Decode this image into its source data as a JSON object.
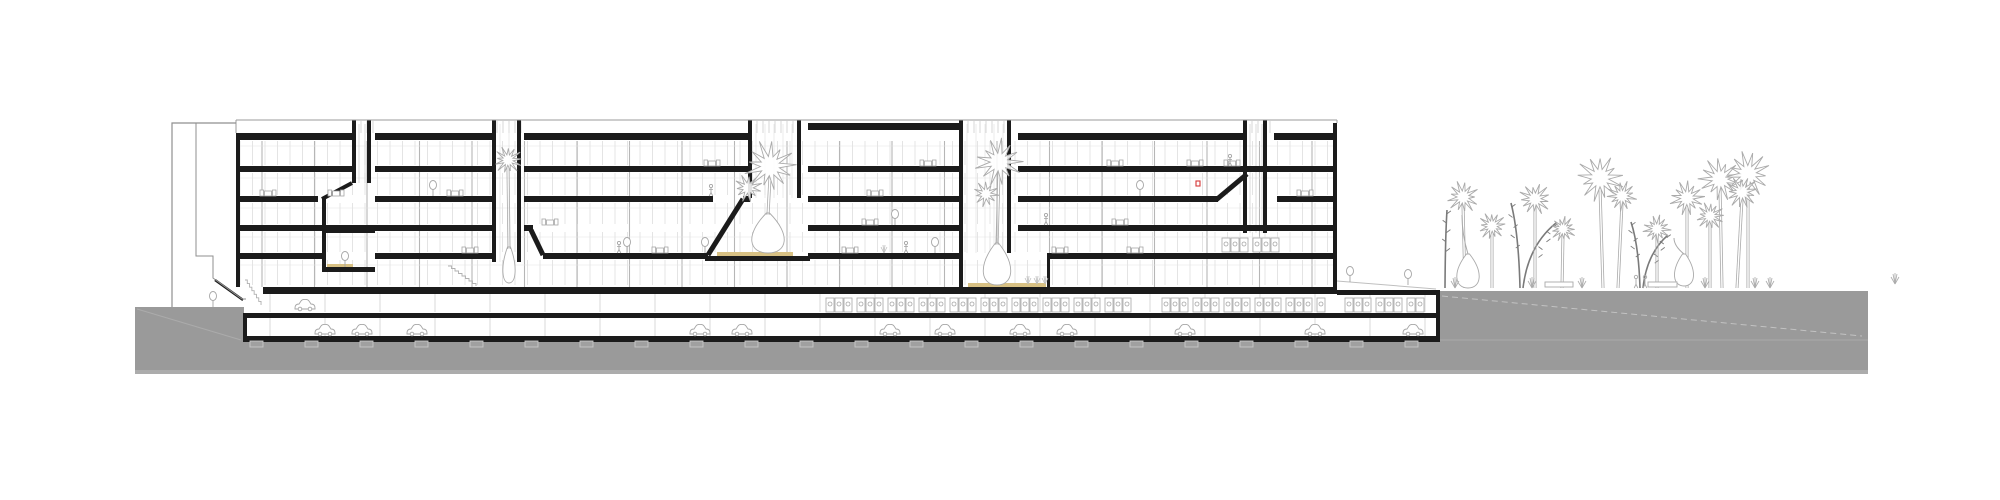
{
  "drawing": {
    "kind": "architectural-building-section",
    "canvas": {
      "w": 2000,
      "h": 500
    }
  },
  "colors": {
    "ink": "#1b1b1b",
    "ground": "#9a9a9a",
    "groundEdge": "#b3b3b3",
    "mullion": "#d9d9d9",
    "column": "#b6b6b6",
    "faint": "#e4e4e4",
    "outline": "#8f8f8f",
    "icon": "#a6a6a6",
    "iconLight": "#bfbfbf",
    "tan": "#d8c184",
    "red": "#d63737",
    "treeLine": "#aaaaaa",
    "treeDark": "#7a7a7a",
    "white": "#ffffff"
  },
  "ground": {
    "surface": [
      [
        135,
        307
      ],
      [
        1436,
        307
      ],
      [
        1436,
        291
      ],
      [
        1868,
        291
      ],
      [
        1868,
        374
      ],
      [
        135,
        374
      ]
    ],
    "bottomStrip": {
      "x1": 135,
      "x2": 1868,
      "y": 370,
      "h": 4
    },
    "leftDiag": [
      [
        137,
        309
      ],
      [
        241,
        340
      ]
    ],
    "rightDash": [
      [
        1442,
        296
      ],
      [
        1862,
        336
      ]
    ],
    "rightFlat": [
      [
        1440,
        340
      ],
      [
        1868,
        340
      ]
    ],
    "frontGrade": [
      [
        1337,
        281
      ],
      [
        1436,
        289
      ]
    ],
    "basementMask": {
      "x": 244,
      "y": 290,
      "w": 1192,
      "h": 47
    }
  },
  "grid": {
    "x1": 240,
    "x2": 1333,
    "mullionStep": 12.5,
    "mullionBands": [
      [
        141,
        165
      ],
      [
        173,
        195
      ],
      [
        203,
        224
      ],
      [
        232,
        252
      ],
      [
        260,
        285
      ]
    ],
    "columnStep": 52.5,
    "columnY": [
      141,
      287
    ],
    "ceilingLines": [
      146,
      178,
      208,
      237,
      265
    ],
    "basementBands": [
      [
        293,
        312
      ],
      [
        318,
        336
      ]
    ],
    "basementStep": 55,
    "basementX": [
      270,
      1430
    ]
  },
  "slabs": [
    {
      "y": 133,
      "h": 7,
      "spans": [
        [
          236,
          352
        ],
        [
          375,
          494
        ],
        [
          524,
          750
        ]
      ]
    },
    {
      "y": 123,
      "h": 7,
      "spans": [
        [
          808,
          962
        ]
      ]
    },
    {
      "y": 133,
      "h": 7,
      "spans": [
        [
          1018,
          1245
        ],
        [
          1274,
          1337
        ]
      ]
    },
    {
      "y": 166,
      "h": 6,
      "spans": [
        [
          236,
          352
        ],
        [
          375,
          494
        ],
        [
          524,
          750
        ],
        [
          808,
          962
        ],
        [
          1018,
          1333
        ]
      ]
    },
    {
      "y": 196,
      "h": 6,
      "spans": [
        [
          236,
          318
        ],
        [
          375,
          494
        ],
        [
          524,
          713
        ],
        [
          743,
          750
        ],
        [
          808,
          962
        ],
        [
          1018,
          1218
        ],
        [
          1277,
          1333
        ]
      ]
    },
    {
      "y": 225,
      "h": 6,
      "spans": [
        [
          240,
          494
        ],
        [
          524,
          533
        ],
        [
          808,
          962
        ],
        [
          1018,
          1333
        ]
      ]
    },
    {
      "y": 228,
      "h": 5,
      "spans": [
        [
          322,
          375
        ]
      ]
    },
    {
      "y": 267,
      "h": 5,
      "spans": [
        [
          322,
          375
        ]
      ]
    },
    {
      "y": 253,
      "h": 6,
      "spans": [
        [
          236,
          322
        ],
        [
          375,
          494
        ],
        [
          543,
          708
        ],
        [
          808,
          962
        ],
        [
          1047,
          1333
        ]
      ]
    },
    {
      "y": 256,
      "h": 5,
      "spans": [
        [
          705,
          810
        ]
      ]
    },
    {
      "y": 287,
      "h": 7,
      "spans": [
        [
          263,
          1337
        ]
      ]
    },
    {
      "y": 313,
      "h": 5,
      "spans": [
        [
          243,
          1440
        ]
      ]
    },
    {
      "y": 336,
      "h": 6,
      "spans": [
        [
          243,
          1440
        ]
      ]
    },
    {
      "y": 290,
      "h": 5,
      "spans": [
        [
          1337,
          1440
        ]
      ]
    }
  ],
  "diagonals": [
    {
      "x1": 322,
      "y1": 199,
      "x2": 352,
      "y2": 183,
      "w": 4
    },
    {
      "x1": 531,
      "y1": 230,
      "x2": 543,
      "y2": 255,
      "w": 5
    },
    {
      "x1": 708,
      "y1": 255,
      "x2": 743,
      "y2": 199,
      "w": 5
    },
    {
      "x1": 1216,
      "y1": 200,
      "x2": 1247,
      "y2": 174,
      "w": 5
    },
    {
      "x1": 215,
      "y1": 280,
      "x2": 243,
      "y2": 300,
      "w": 2.4
    }
  ],
  "walls": [
    {
      "x": 236,
      "y": 133,
      "w": 4,
      "h": 154
    },
    {
      "x": 1333,
      "y": 123,
      "w": 4,
      "h": 167
    },
    {
      "x": 243,
      "y": 318,
      "w": 4,
      "h": 24
    },
    {
      "x": 1436,
      "y": 290,
      "w": 4,
      "h": 52
    },
    {
      "x": 322,
      "y": 199,
      "w": 4,
      "h": 68
    }
  ],
  "cores": [
    {
      "x1": 492,
      "x2": 521,
      "yTop": 120,
      "yBot": 262,
      "shaft": false
    },
    {
      "x1": 748,
      "x2": 801,
      "yTop": 120,
      "yBot": 198,
      "shaft": false
    },
    {
      "x1": 959,
      "x2": 1011,
      "yTop": 120,
      "yBot": 253,
      "shaft": false,
      "leftDeep": 287,
      "extraWall": {
        "x": 1047,
        "y1": 253,
        "y2": 287
      }
    },
    {
      "x1": 1243,
      "x2": 1267,
      "yTop": 120,
      "yBot": 233,
      "shaft": true
    },
    {
      "x1": 352,
      "x2": 371,
      "yTop": 120,
      "yBot": 183,
      "shaft": true
    }
  ],
  "clerestories": [
    [
      352,
      375
    ],
    [
      494,
      525
    ],
    [
      748,
      805
    ],
    [
      959,
      1015
    ],
    [
      1243,
      1271
    ]
  ],
  "parapet": {
    "y": 120,
    "x1": 236,
    "x2": 1337
  },
  "tanFloors": [
    {
      "x1": 717,
      "x2": 793,
      "y": 252,
      "h": 4
    },
    {
      "x1": 968,
      "x2": 1046,
      "y": 283,
      "h": 4
    },
    {
      "x1": 327,
      "x2": 353,
      "y": 264,
      "h": 3
    }
  ],
  "annex": {
    "outer": "M236,123 H172 V307",
    "inner": "M196,123 V256 H213 V278 L242,299 H246",
    "cap": [
      [
        172,
        123
      ],
      [
        236,
        123
      ]
    ]
  },
  "stairs": [
    {
      "x": 245,
      "y": 280,
      "w": 16,
      "h": 25,
      "steps": 7
    },
    {
      "x": 448,
      "y": 266,
      "w": 28,
      "h": 20,
      "steps": 8
    }
  ],
  "lockerRuns": [
    {
      "x1": 826,
      "x2": 1132,
      "y": 298
    },
    {
      "x1": 1162,
      "x2": 1332,
      "y": 298
    },
    {
      "x1": 1345,
      "x2": 1425,
      "y": 298
    },
    {
      "x1": 1222,
      "x2": 1283,
      "y": 238
    }
  ],
  "cars": {
    "b2y": 328,
    "b2x": [
      325,
      362,
      417,
      700,
      742,
      890,
      945,
      1020,
      1067,
      1185,
      1315,
      1413
    ],
    "b1y": 303,
    "b1x": [
      305
    ]
  },
  "footings": {
    "from": 250,
    "to": 1430,
    "step": 55,
    "y": 341,
    "w": 13,
    "h": 6
  },
  "furniture": {
    "tables": [
      [
        268,
        196
      ],
      [
        336,
        196
      ],
      [
        455,
        196
      ],
      [
        875,
        196
      ],
      [
        1305,
        196
      ],
      [
        712,
        166
      ],
      [
        928,
        166
      ],
      [
        1115,
        166
      ],
      [
        1195,
        166
      ],
      [
        1232,
        166
      ],
      [
        550,
        225
      ],
      [
        870,
        225
      ],
      [
        1120,
        225
      ],
      [
        470,
        253
      ],
      [
        660,
        253
      ],
      [
        850,
        253
      ],
      [
        1060,
        253
      ],
      [
        1135,
        253
      ]
    ],
    "plants": [
      [
        433,
        196
      ],
      [
        895,
        225
      ],
      [
        627,
        253
      ],
      [
        705,
        253
      ],
      [
        935,
        253
      ],
      [
        1140,
        196
      ],
      [
        213,
        307
      ],
      [
        345,
        267
      ],
      [
        1350,
        282
      ],
      [
        1408,
        285
      ]
    ],
    "people": [
      [
        619,
        253
      ],
      [
        711,
        196
      ],
      [
        1046,
        225
      ],
      [
        1230,
        166
      ],
      [
        906,
        253
      ]
    ],
    "reds": [
      [
        1196,
        186
      ]
    ],
    "grass": [
      [
        1028,
        284
      ],
      [
        1037,
        284
      ],
      [
        1045,
        284
      ],
      [
        884,
        253
      ]
    ]
  },
  "vegetation": {
    "interiorPalms": [
      {
        "x": 509,
        "baseY": 283,
        "hx": 508,
        "hy": 160,
        "r": 13,
        "bulb": {
          "bw": 14,
          "bh": 36
        },
        "head2": null
      },
      {
        "x": 768,
        "baseY": 253,
        "hx": 770,
        "hy": 166,
        "r": 24,
        "bulb": {
          "bw": 38,
          "bh": 40
        },
        "head2": {
          "x": 748,
          "y": 188,
          "r": 13
        }
      },
      {
        "x": 997,
        "baseY": 285,
        "hx": 999,
        "hy": 162,
        "r": 22,
        "bulb": {
          "bw": 32,
          "bh": 42
        },
        "head2": {
          "x": 986,
          "y": 194,
          "r": 12
        }
      }
    ],
    "exteriorPalms": [
      {
        "x": 1465,
        "hx": 1463,
        "hy": 197,
        "r": 15
      },
      {
        "x": 1492,
        "hx": 1492,
        "hy": 226,
        "r": 13
      },
      {
        "x": 1535,
        "hx": 1535,
        "hy": 199,
        "r": 15
      },
      {
        "x": 1562,
        "hx": 1563,
        "hy": 229,
        "r": 12
      },
      {
        "x": 1603,
        "hx": 1600,
        "hy": 178,
        "r": 22
      },
      {
        "x": 1618,
        "hx": 1622,
        "hy": 196,
        "r": 14
      },
      {
        "x": 1657,
        "hx": 1657,
        "hy": 229,
        "r": 13
      },
      {
        "x": 1687,
        "hx": 1687,
        "hy": 198,
        "r": 16
      },
      {
        "x": 1722,
        "hx": 1720,
        "hy": 179,
        "r": 20
      },
      {
        "x": 1748,
        "hx": 1748,
        "hy": 174,
        "r": 21
      },
      {
        "x": 1710,
        "hx": 1710,
        "hy": 216,
        "r": 13
      },
      {
        "x": 1737,
        "hx": 1742,
        "hy": 192,
        "r": 15
      }
    ],
    "bottleTrees": [
      {
        "x": 1468,
        "baseY": 288,
        "bw": 26,
        "bh": 34,
        "nx": 1462,
        "ny": 215
      },
      {
        "x": 1684,
        "baseY": 286,
        "bw": 22,
        "bh": 32,
        "nx": 1674,
        "ny": 238
      }
    ],
    "darkTrees": [
      {
        "x1": 1520,
        "y1": 288,
        "x2": 1511,
        "y2": 203
      },
      {
        "x1": 1523,
        "y1": 288,
        "x2": 1556,
        "y2": 223
      },
      {
        "x1": 1640,
        "y1": 288,
        "x2": 1631,
        "y2": 222
      },
      {
        "x1": 1643,
        "y1": 288,
        "x2": 1668,
        "y2": 235
      },
      {
        "x1": 1445,
        "y1": 288,
        "x2": 1447,
        "y2": 210
      }
    ],
    "shrubs": [
      [
        1455,
        288
      ],
      [
        1532,
        288
      ],
      [
        1582,
        288
      ],
      [
        1705,
        288
      ],
      [
        1755,
        288
      ],
      [
        1770,
        288
      ],
      [
        1895,
        284
      ]
    ],
    "peopleOut": [
      [
        1636,
        288
      ],
      [
        1645,
        288
      ]
    ],
    "benches": [
      [
        1545,
        282,
        28,
        5
      ],
      [
        1648,
        282,
        29,
        5
      ]
    ]
  }
}
